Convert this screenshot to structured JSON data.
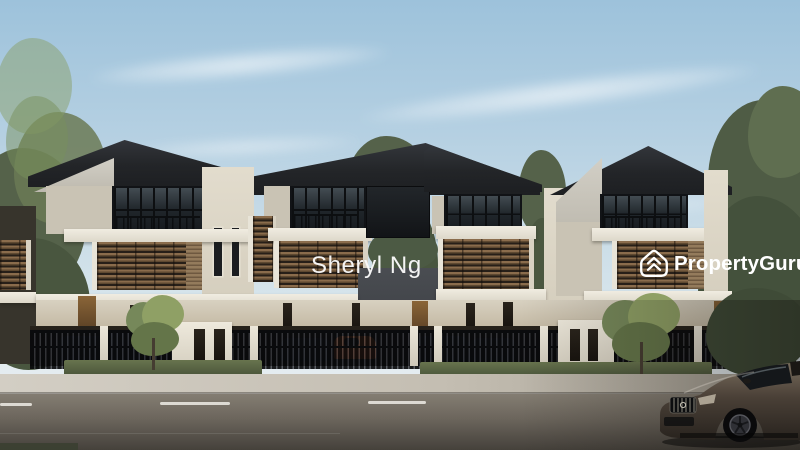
{
  "image": {
    "type": "property-listing-photo",
    "subject": "3D architectural render of a row of modern three-storey terrace villas with dark pitched roofs, timber louvre balconies, glass facades, black metal fences, front road and luxury car",
    "width": 800,
    "height": 450
  },
  "watermarks": {
    "agent_name": "Sheryl Ng",
    "brand": {
      "property": "Property",
      "guru": "Guru",
      "full": "PropertyGuru",
      "icon": "propertyguru-house-icon",
      "color": "#ffffff"
    }
  },
  "palette": {
    "sky_top": "#9dc2db",
    "sky_horizon": "#e9eff1",
    "roof": "#232528",
    "wall_cream": "#ddd7c9",
    "white_band": "#f0ece1",
    "louvre_wood": "#7a5f42",
    "glass": "#1d2125",
    "fence": "#131417",
    "grass": "#5e6a47",
    "foliage_dark": "#4e5c44",
    "foliage_bright": "#8fa065",
    "pavement": "#c4beb2",
    "road": "#6b655c",
    "foreground_car": "#4a4037",
    "parked_car_orange": "#d8681f"
  },
  "scene": {
    "houses_visible": 4,
    "foreground_car": "dark bronze luxury coupe, front three-quarter view, lower right",
    "parked_cars_behind_fence": 6,
    "road_marking": "white dashed centre line"
  }
}
